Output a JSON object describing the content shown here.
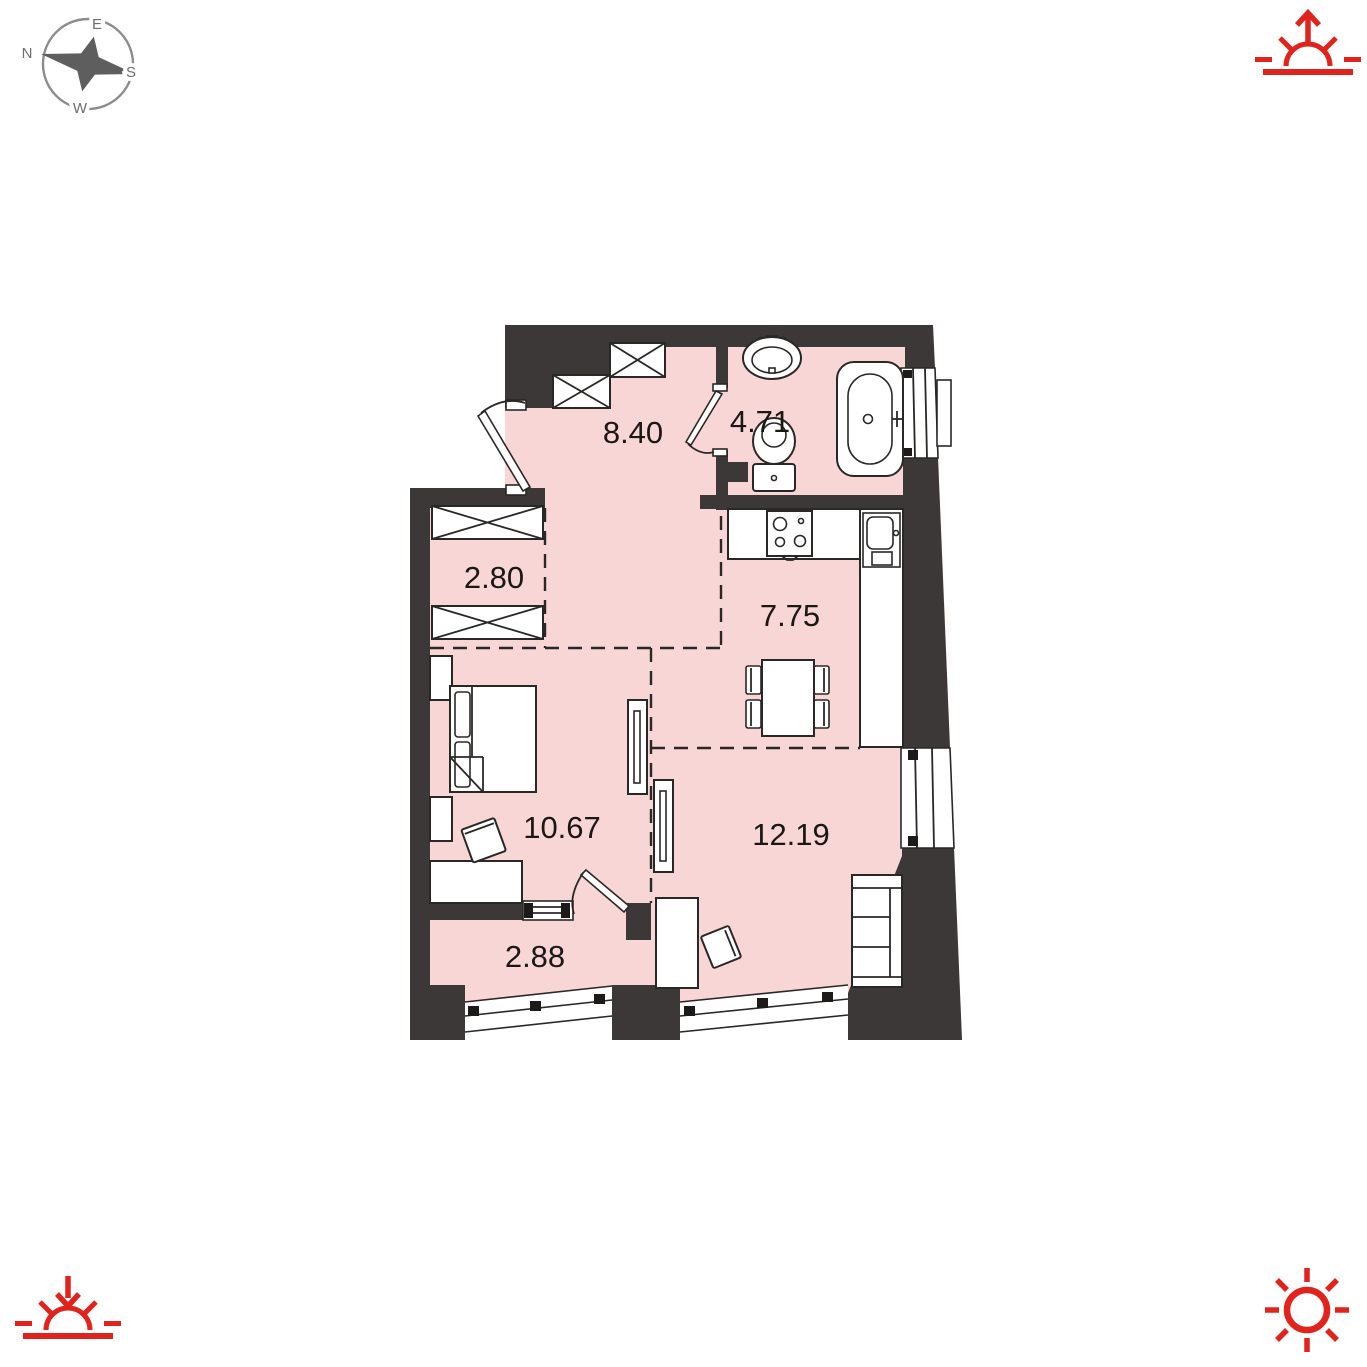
{
  "title": "apartment-floor-plan",
  "colors": {
    "room_fill": "#f8d6d6",
    "wall": "#3b3837",
    "outline": "#2a2826",
    "accent_red": "#e0231c",
    "compass_gray": "#6e6e6e",
    "label_text": "#1a1715"
  },
  "compass": {
    "labels": {
      "n": "N",
      "e": "E",
      "s": "S",
      "w": "W"
    }
  },
  "corner_icons": {
    "top_right": "sunrise-arrow-up",
    "bottom_left": "sunset-arrow-down",
    "bottom_right": "sun"
  },
  "floor_plan": {
    "rooms": [
      {
        "name": "hallway",
        "area": "8.40"
      },
      {
        "name": "bathroom",
        "area": "4.71"
      },
      {
        "name": "closet",
        "area": "2.80"
      },
      {
        "name": "kitchen",
        "area": "7.75"
      },
      {
        "name": "bedroom",
        "area": "10.67"
      },
      {
        "name": "living-room",
        "area": "12.19"
      },
      {
        "name": "balcony",
        "area": "2.88"
      }
    ]
  }
}
